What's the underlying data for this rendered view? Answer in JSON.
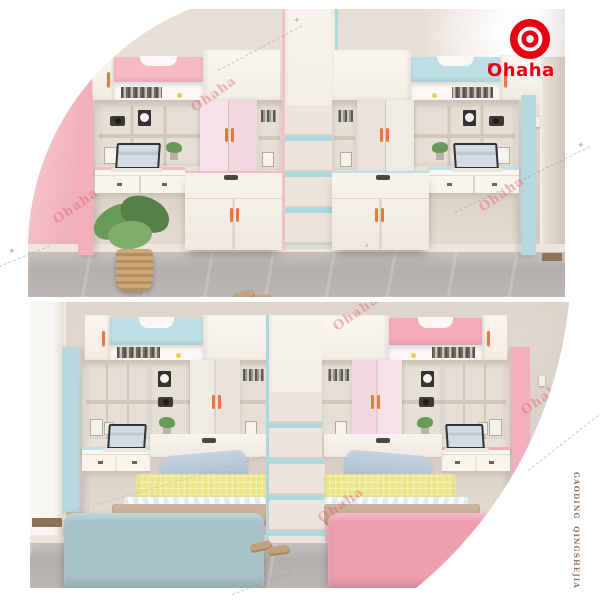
{
  "brand": {
    "logo_text": "Ohaha",
    "registered_mark": "®",
    "watermark_text": "Ohaha",
    "vertical_side_text": "GAODING QINGSHEJIA"
  },
  "decor": {
    "sparkle_glyph": "✦"
  },
  "colors": {
    "brand-red": "#e60012",
    "wall-beige": "#dbd1c8",
    "wall-pink": "#f0b0bc",
    "floor-gray": "#b5b0ac",
    "furniture-cream": "#e9e2d9",
    "furniture-white": "#f8f4ee",
    "accent-pink": "#f6bac4",
    "accent-pink-door": "#f6e2e7",
    "accent-pink-panel": "#f3aebb",
    "accent-pink-bed": "#efa0af",
    "accent-teal": "#bedfe5",
    "accent-teal-door": "#f0ebe4",
    "accent-teal-panel": "#b7d8de",
    "accent-teal-bed": "#a8c4ca",
    "stair-step-teal": "#abd9e1",
    "handle-orange": "#e9763d",
    "pillow-blue": "#a9bccd",
    "blanket-yellow": "#ebe78a",
    "blanket-tan": "#c8b098",
    "watermark-pink": "rgba(225,92,102,0.42)",
    "side-text-brown": "#8a7162"
  },
  "photos": {
    "top": {
      "alt": "Two loft units with overhead bunks, wardrobes and desks; pink unit left, blue unit right, staircase in middle"
    },
    "bottom": {
      "alt": "Two single beds under loft storage with desks; blue bed left, pink bed right, staircase in middle"
    }
  }
}
